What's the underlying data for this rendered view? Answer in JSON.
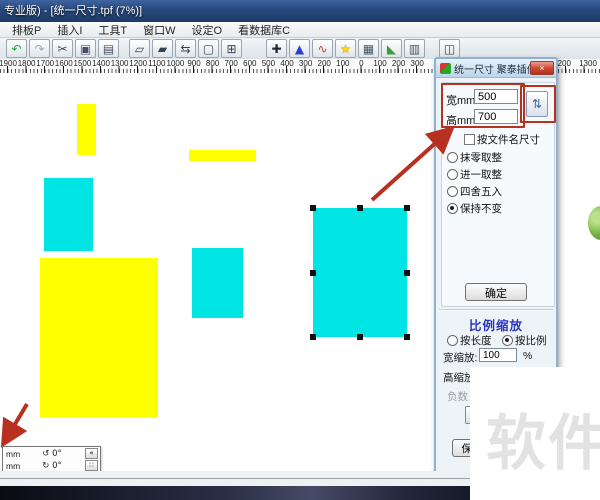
{
  "colors": {
    "titlebar_blue": "#27497c",
    "annotation_red": "#b8301f",
    "shape_yellow": "#ffff00",
    "shape_cyan": "#00e4e4",
    "section_title_blue": "#2b35c0",
    "watermark_gray": "#e2e2e2"
  },
  "window": {
    "title": "专业版) - [统一尺寸.tpf (7%)]"
  },
  "menu": {
    "items": [
      {
        "label": "排板P"
      },
      {
        "label": "插入I"
      },
      {
        "label": "工具T"
      },
      {
        "label": "窗口W"
      },
      {
        "label": "设定O"
      },
      {
        "label": "看数据库C"
      }
    ]
  },
  "toolbar": {
    "icons": [
      {
        "name": "undo-icon",
        "glyph": "↶",
        "color": "#1faa3c",
        "gap": 0
      },
      {
        "name": "redo-icon",
        "glyph": "↷",
        "color": "#9aa8b8",
        "gap": 0
      },
      {
        "name": "cut-icon",
        "glyph": "✂",
        "color": "#444c55",
        "gap": 0
      },
      {
        "name": "copy-icon",
        "glyph": "▣",
        "color": "#44506a",
        "gap": 0
      },
      {
        "name": "paste-icon",
        "glyph": "▤",
        "color": "#44506a",
        "gap": 0
      },
      {
        "name": "nest-pieces-icon",
        "glyph": "▱",
        "color": "#334455",
        "gap": 8
      },
      {
        "name": "nest-offset-icon",
        "glyph": "▰",
        "color": "#334455",
        "gap": 0
      },
      {
        "name": "swap-order-icon",
        "glyph": "⇆",
        "color": "#334455",
        "gap": 0
      },
      {
        "name": "overlap-check-icon",
        "glyph": "▢",
        "color": "#334455",
        "gap": 0
      },
      {
        "name": "window-layout-icon",
        "glyph": "⊞",
        "color": "#334455",
        "gap": 0
      },
      {
        "name": "move-piece-icon",
        "glyph": "✚",
        "color": "#22283a",
        "gap": 22
      },
      {
        "name": "shape-tools-icon",
        "glyph": "▲",
        "color": "#2b3fd0",
        "gap": 0
      },
      {
        "name": "color-curve-icon",
        "glyph": "∿",
        "color": "#c44333",
        "gap": 0
      },
      {
        "name": "star-icon",
        "glyph": "★",
        "color": "#ffd800",
        "gap": 0
      },
      {
        "name": "mesh-icon",
        "glyph": "▦",
        "color": "#445566",
        "gap": 0
      },
      {
        "name": "terrain-icon",
        "glyph": "◣",
        "color": "#3d9e3d",
        "gap": 0
      },
      {
        "name": "plot-icon",
        "glyph": "▥",
        "color": "#445566",
        "gap": 0
      },
      {
        "name": "print-preview-icon",
        "glyph": "◫",
        "color": "#334455",
        "gap": 12
      }
    ]
  },
  "ruler": {
    "labels": [
      "1900",
      "1800",
      "1700",
      "1600",
      "1500",
      "1400",
      "1300",
      "1200",
      "1100",
      "1000",
      "900",
      "800",
      "700",
      "600",
      "500",
      "400",
      "300",
      "200",
      "100",
      "0",
      "100",
      "200",
      "300"
    ],
    "labels_right": [
      "1200",
      "1300"
    ]
  },
  "canvas": {
    "shapes": [
      {
        "name": "yellow-piece-small",
        "color": "#ffff00",
        "x": 77,
        "y": 104,
        "w": 19,
        "h": 51,
        "selected": false
      },
      {
        "name": "yellow-piece-bar",
        "color": "#ffff00",
        "x": 189,
        "y": 150,
        "w": 67,
        "h": 11,
        "selected": false
      },
      {
        "name": "cyan-piece-left",
        "color": "#00e4e4",
        "x": 44,
        "y": 178,
        "w": 49,
        "h": 73,
        "selected": false
      },
      {
        "name": "yellow-piece-large",
        "color": "#ffff00",
        "x": 40,
        "y": 258,
        "w": 118,
        "h": 160,
        "selected": false
      },
      {
        "name": "cyan-piece-middle",
        "color": "#00e4e4",
        "x": 192,
        "y": 248,
        "w": 51,
        "h": 70,
        "selected": false
      },
      {
        "name": "cyan-piece-selected",
        "color": "#00e4e4",
        "x": 313,
        "y": 208,
        "w": 94,
        "h": 129,
        "selected": true
      }
    ]
  },
  "dialog": {
    "title": "统一尺寸 聚泰插件...",
    "close_glyph": "×",
    "width_label": "宽mm",
    "width_value": "500",
    "height_label": "高mm",
    "height_value": "700",
    "swap_glyph": "⇅",
    "filename_checkbox_label": "按文件名尺寸",
    "rounding_options": [
      {
        "label": "抹零取整",
        "selected": false
      },
      {
        "label": "进一取整",
        "selected": false
      },
      {
        "label": "四舍五入",
        "selected": false
      },
      {
        "label": "保持不变",
        "selected": true
      }
    ],
    "ok_label": "确定",
    "scale_section_title": "比例缩放",
    "scale_options": [
      {
        "label": "按长度",
        "selected": false
      },
      {
        "label": "按比例",
        "selected": true
      }
    ],
    "width_scale_label": "宽缩放:",
    "width_scale_value": "100",
    "width_scale_unit": "%",
    "height_scale_label": "高缩放",
    "negative_label": "负数",
    "keep_button_label": "保持"
  },
  "statusbar": {
    "rows": [
      {
        "unit": "mm",
        "angle": "↺ 0°"
      },
      {
        "unit": "mm",
        "angle": "↻ 0°"
      }
    ],
    "buttons": [
      {
        "name": "collapse-panel-button",
        "glyph": "«"
      },
      {
        "name": "grid-snap-button",
        "glyph": "∷"
      }
    ]
  },
  "watermark": {
    "text": "软件"
  }
}
